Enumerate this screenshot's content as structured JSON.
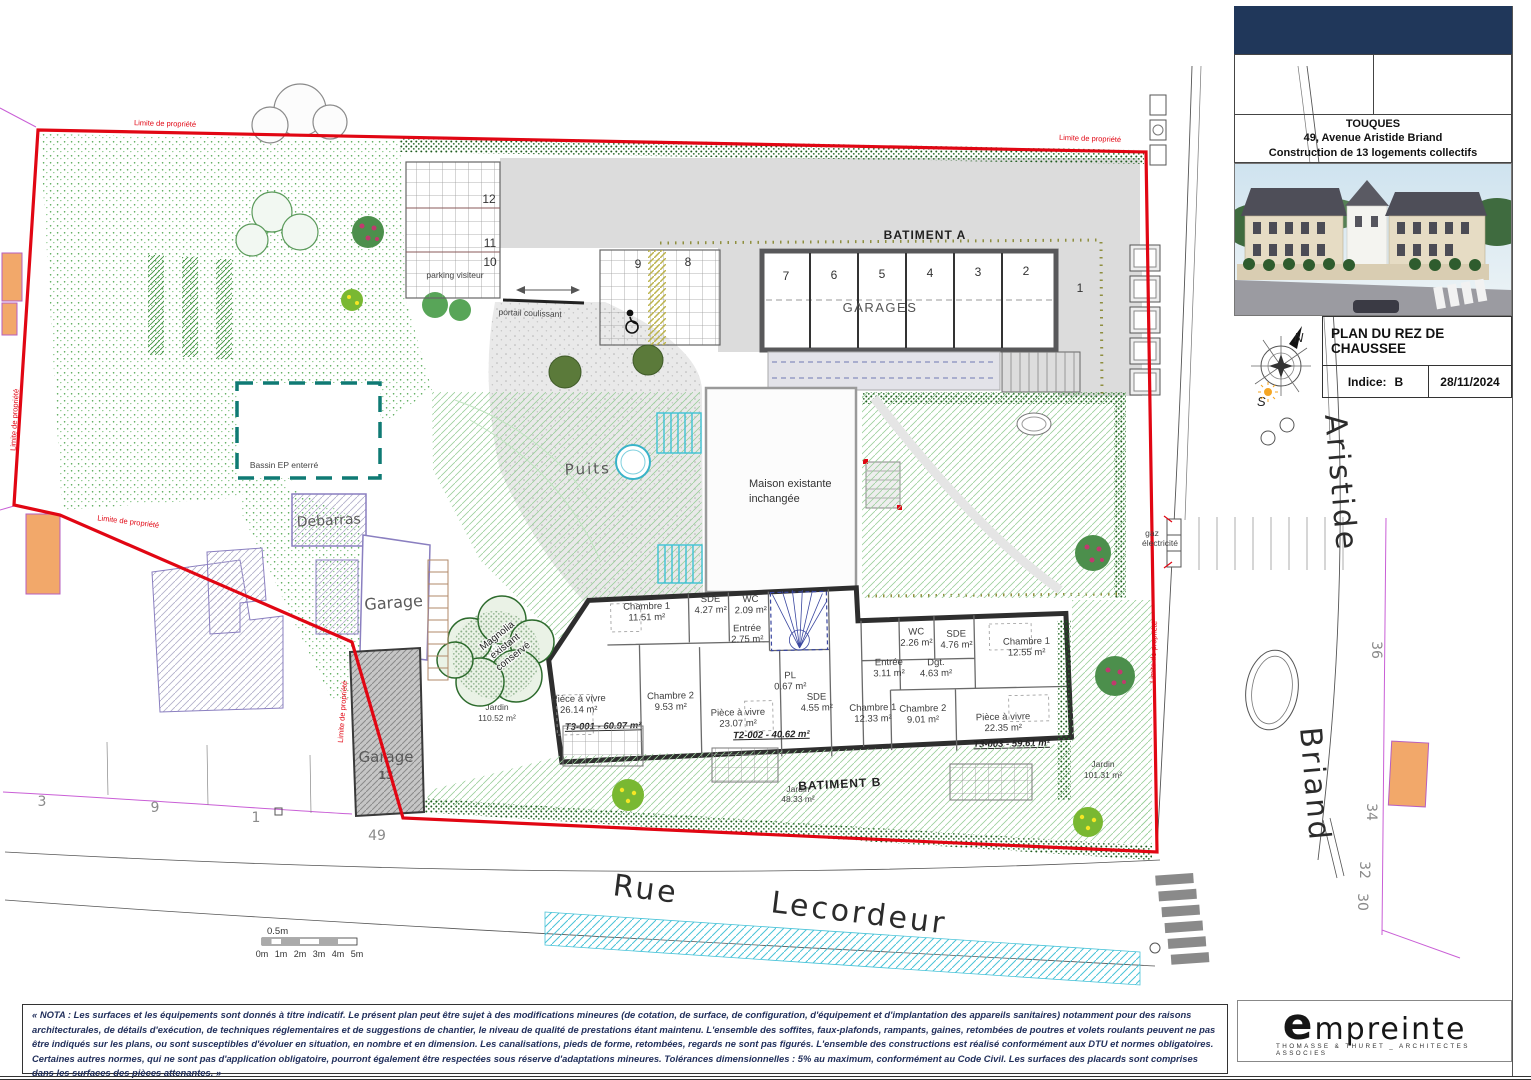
{
  "sheet": {
    "title_block": {
      "city": "TOUQUES",
      "address": "49, Avenue Aristide Briand",
      "project": "Construction de 13 logements collectifs",
      "plan_title": "PLAN DU REZ DE CHAUSSEE",
      "indice_label": "Indice:",
      "indice_value": "B",
      "date": "28/11/2024",
      "compass_n": "N",
      "compass_s": "S"
    },
    "logo": {
      "name": "empreinte",
      "tagline": "THOMASSE & THURET _ ARCHITECTES ASSOCIES"
    },
    "nota": "« NOTA : Les surfaces et les équipements sont donnés à titre indicatif. Le présent plan peut être sujet à des modifications mineures (de cotation, de surface, de configuration, d'équipement et d'implantation des appareils sanitaires) notamment pour des raisons architecturales, de détails d'exécution, de techniques réglementaires et de suggestions de chantier, le niveau de qualité de prestations étant maintenu. L'ensemble des soffites, faux-plafonds, rampants, gaines, retombées de poutres et volets roulants peuvent ne pas être indiqués sur les plans, ou sont susceptibles d'évoluer en situation, en nombre et en dimension. Les canalisations, pieds de forme, retombées, regards ne sont pas figurés. L'ensemble des constructions est réalisé conformément aux DTU et normes obligatoires. Certaines autres normes, qui ne sont pas d'application obligatoire, pourront également être respectées sous réserve d'adaptations mineures. Tolérances dimensionnelles : 5% au maximum, conformément au Code Civil. Les surfaces des placards sont comprises dans les surfaces des pièces attenantes. »"
  },
  "streets": {
    "rue": "Rue",
    "lecordeur": "Lecordeur",
    "aristide": "Aristide",
    "briand": "Briand"
  },
  "boundary_label": "Limite de propriété",
  "buildings": {
    "batiment_a": "BATIMENT A",
    "garages_label": "GARAGES",
    "batiment_b": "BATIMENT B",
    "maison_l1": "Maison existante",
    "maison_l2": "inchangée",
    "debarras": "Debarras",
    "garage": "Garage",
    "garage13_label": "Garage",
    "garage13_num": "13"
  },
  "site": {
    "puits": "Puits",
    "bassin": "Bassin EP enterré",
    "parking_visiteur": "parking visiteur",
    "portail": "portail coulissant",
    "magnolia_l1": "Magnolia",
    "magnolia_l2": "existant",
    "magnolia_l3": "conservé",
    "gaz_l1": "gaz",
    "gaz_l2": "électricité"
  },
  "jardins": [
    {
      "label": "Jardin",
      "area": "110.52 m²"
    },
    {
      "label": "Jardin",
      "area": "48.33 m²"
    },
    {
      "label": "Jardin",
      "area": "101.31 m²"
    }
  ],
  "parking": {
    "spots_visiteur": [
      "12",
      "11",
      "10"
    ],
    "spots_entry": [
      "9",
      "8"
    ],
    "garage_stalls": [
      "7",
      "6",
      "5",
      "4",
      "3",
      "2"
    ],
    "spot_1": "1"
  },
  "house_numbers": {
    "n3": "3",
    "n9": "9",
    "n1": "1",
    "n49": "49",
    "n36": "36",
    "n34": "34",
    "n32": "32",
    "n30": "30"
  },
  "scale_bar": {
    "half": "0.5m",
    "ticks": [
      "0m",
      "1m",
      "2m",
      "3m",
      "4m",
      "5m"
    ]
  },
  "apartments": [
    {
      "id": "T3-001 - 60.97 m²",
      "rooms": [
        {
          "n": "Chambre 1",
          "a": "11.51 m²"
        },
        {
          "n": "SDE",
          "a": "4.27 m²"
        },
        {
          "n": "WC",
          "a": "2.09 m²"
        },
        {
          "n": "Entrée",
          "a": "2.75 m²"
        },
        {
          "n": "Pièce à vivre",
          "a": "26.14 m²"
        },
        {
          "n": "Chambre 2",
          "a": "9.53 m²"
        }
      ]
    },
    {
      "id": "T2-002 - 40.62 m²",
      "rooms": [
        {
          "n": "Pièce à vivre",
          "a": "23.07 m²"
        },
        {
          "n": "PL",
          "a": "0.67 m²"
        },
        {
          "n": "SDE",
          "a": "4.55 m²"
        },
        {
          "n": "Chambre 1",
          "a": "12.33 m²"
        }
      ]
    },
    {
      "id": "T3-003 - 59.61 m²",
      "rooms": [
        {
          "n": "WC",
          "a": "2.26 m²"
        },
        {
          "n": "SDE",
          "a": "4.76 m²"
        },
        {
          "n": "Entrée",
          "a": "3.11 m²"
        },
        {
          "n": "Dgt.",
          "a": "4.63 m²"
        },
        {
          "n": "Chambre 1",
          "a": "12.55 m²"
        },
        {
          "n": "Chambre 2",
          "a": "9.01 m²"
        },
        {
          "n": "Pièce à vivre",
          "a": "22.35 m²"
        }
      ]
    }
  ],
  "colors": {
    "boundary": "#e10613",
    "navy": "#20375a",
    "hedge": "#1c5c1c",
    "lawn": "#8cc98c",
    "cyan": "#3ec2d4",
    "bassin": "#0f7a74"
  }
}
